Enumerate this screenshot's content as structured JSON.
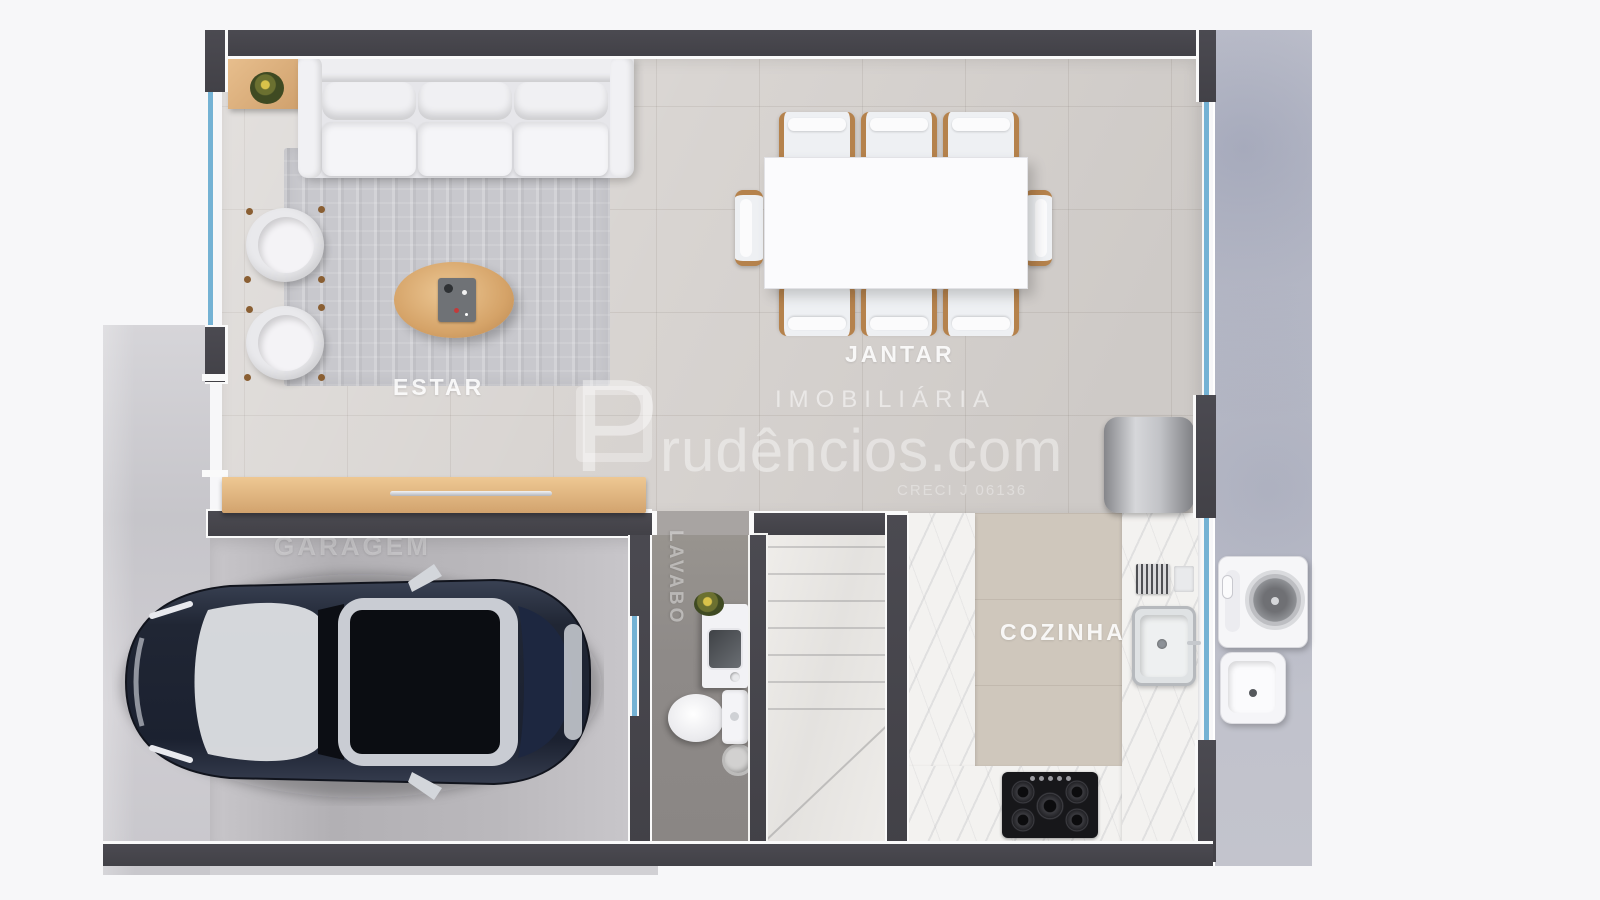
{
  "page": {
    "background": "#f7f7f9"
  },
  "floor_plan": {
    "rooms": [
      {
        "id": "estar",
        "label": "ESTAR"
      },
      {
        "id": "jantar",
        "label": "JANTAR"
      },
      {
        "id": "garagem",
        "label": "GARAGEM"
      },
      {
        "id": "lavabo",
        "label": "LAVABO"
      },
      {
        "id": "cozinha",
        "label": "COZINHA"
      }
    ],
    "colors": {
      "wall": "#46454c",
      "floor_tile": "#d8d4d1",
      "garage_floor": "#bab8bc",
      "lavabo_floor": "#8e8a88",
      "kitchen_floor": "#cfc7bc",
      "marble": "#f3f2f0",
      "wood": "#d9ab77",
      "glass": "#74b2d4",
      "concrete": "#c7c6cc",
      "car_body": "#232936"
    }
  },
  "watermark": {
    "brand_initial": "P",
    "brand_rest": "rudêncios.com",
    "tagline": "IMOBILIÁRIA",
    "registry": "CRECI J 06136"
  }
}
